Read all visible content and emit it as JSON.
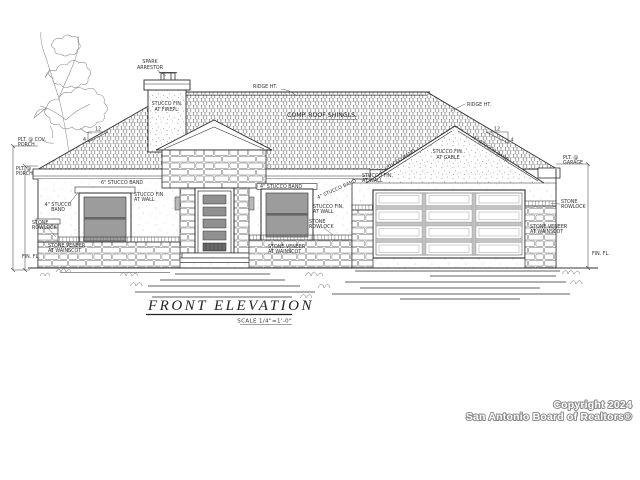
{
  "title": {
    "text": "FRONT ELEVATION",
    "scale": "SCALE 1/4\"=1'-0\""
  },
  "watermark": {
    "line1": "Copyright 2024",
    "line2": "San Antonio Board of Realtors®"
  },
  "labels": {
    "spark1": "SPARK",
    "spark2": "ARRESTOR",
    "ridge_ht": "RIDGE HT.",
    "shingles": "COMP. ROOF SHINGLS.",
    "stucco_fin": "STUCCO FIN.",
    "at_firepl": "AT FIREPL.",
    "at_gable": "AT GABLE",
    "at_wall": "AT WALL",
    "band4": "4\" STUCCO BAND",
    "band4a": "4\" STUCCO",
    "band4b": "BAND",
    "band6": "6\" STUCCO BAND",
    "stone": "STONE",
    "rowlock": "ROWLOCK",
    "stone_veneer": "STONE VENEER",
    "at_wainscot": "AT WAINSCOT",
    "plt_cov": "PLT. @ COV.",
    "porch": "PORCH",
    "plt_at": "PLT. @",
    "garage": "GARAGE",
    "fin_fl": "FIN. FL.",
    "pitch_run": "12",
    "pitch_rise": "4"
  },
  "colors": {
    "line": "#2e2e2e",
    "glass": "#9c9c9c",
    "garage_rail": "#c3c3c3",
    "paper": "#ffffff",
    "watermark_fill": "#ffffff",
    "watermark_outline": "#8c8c8c"
  }
}
